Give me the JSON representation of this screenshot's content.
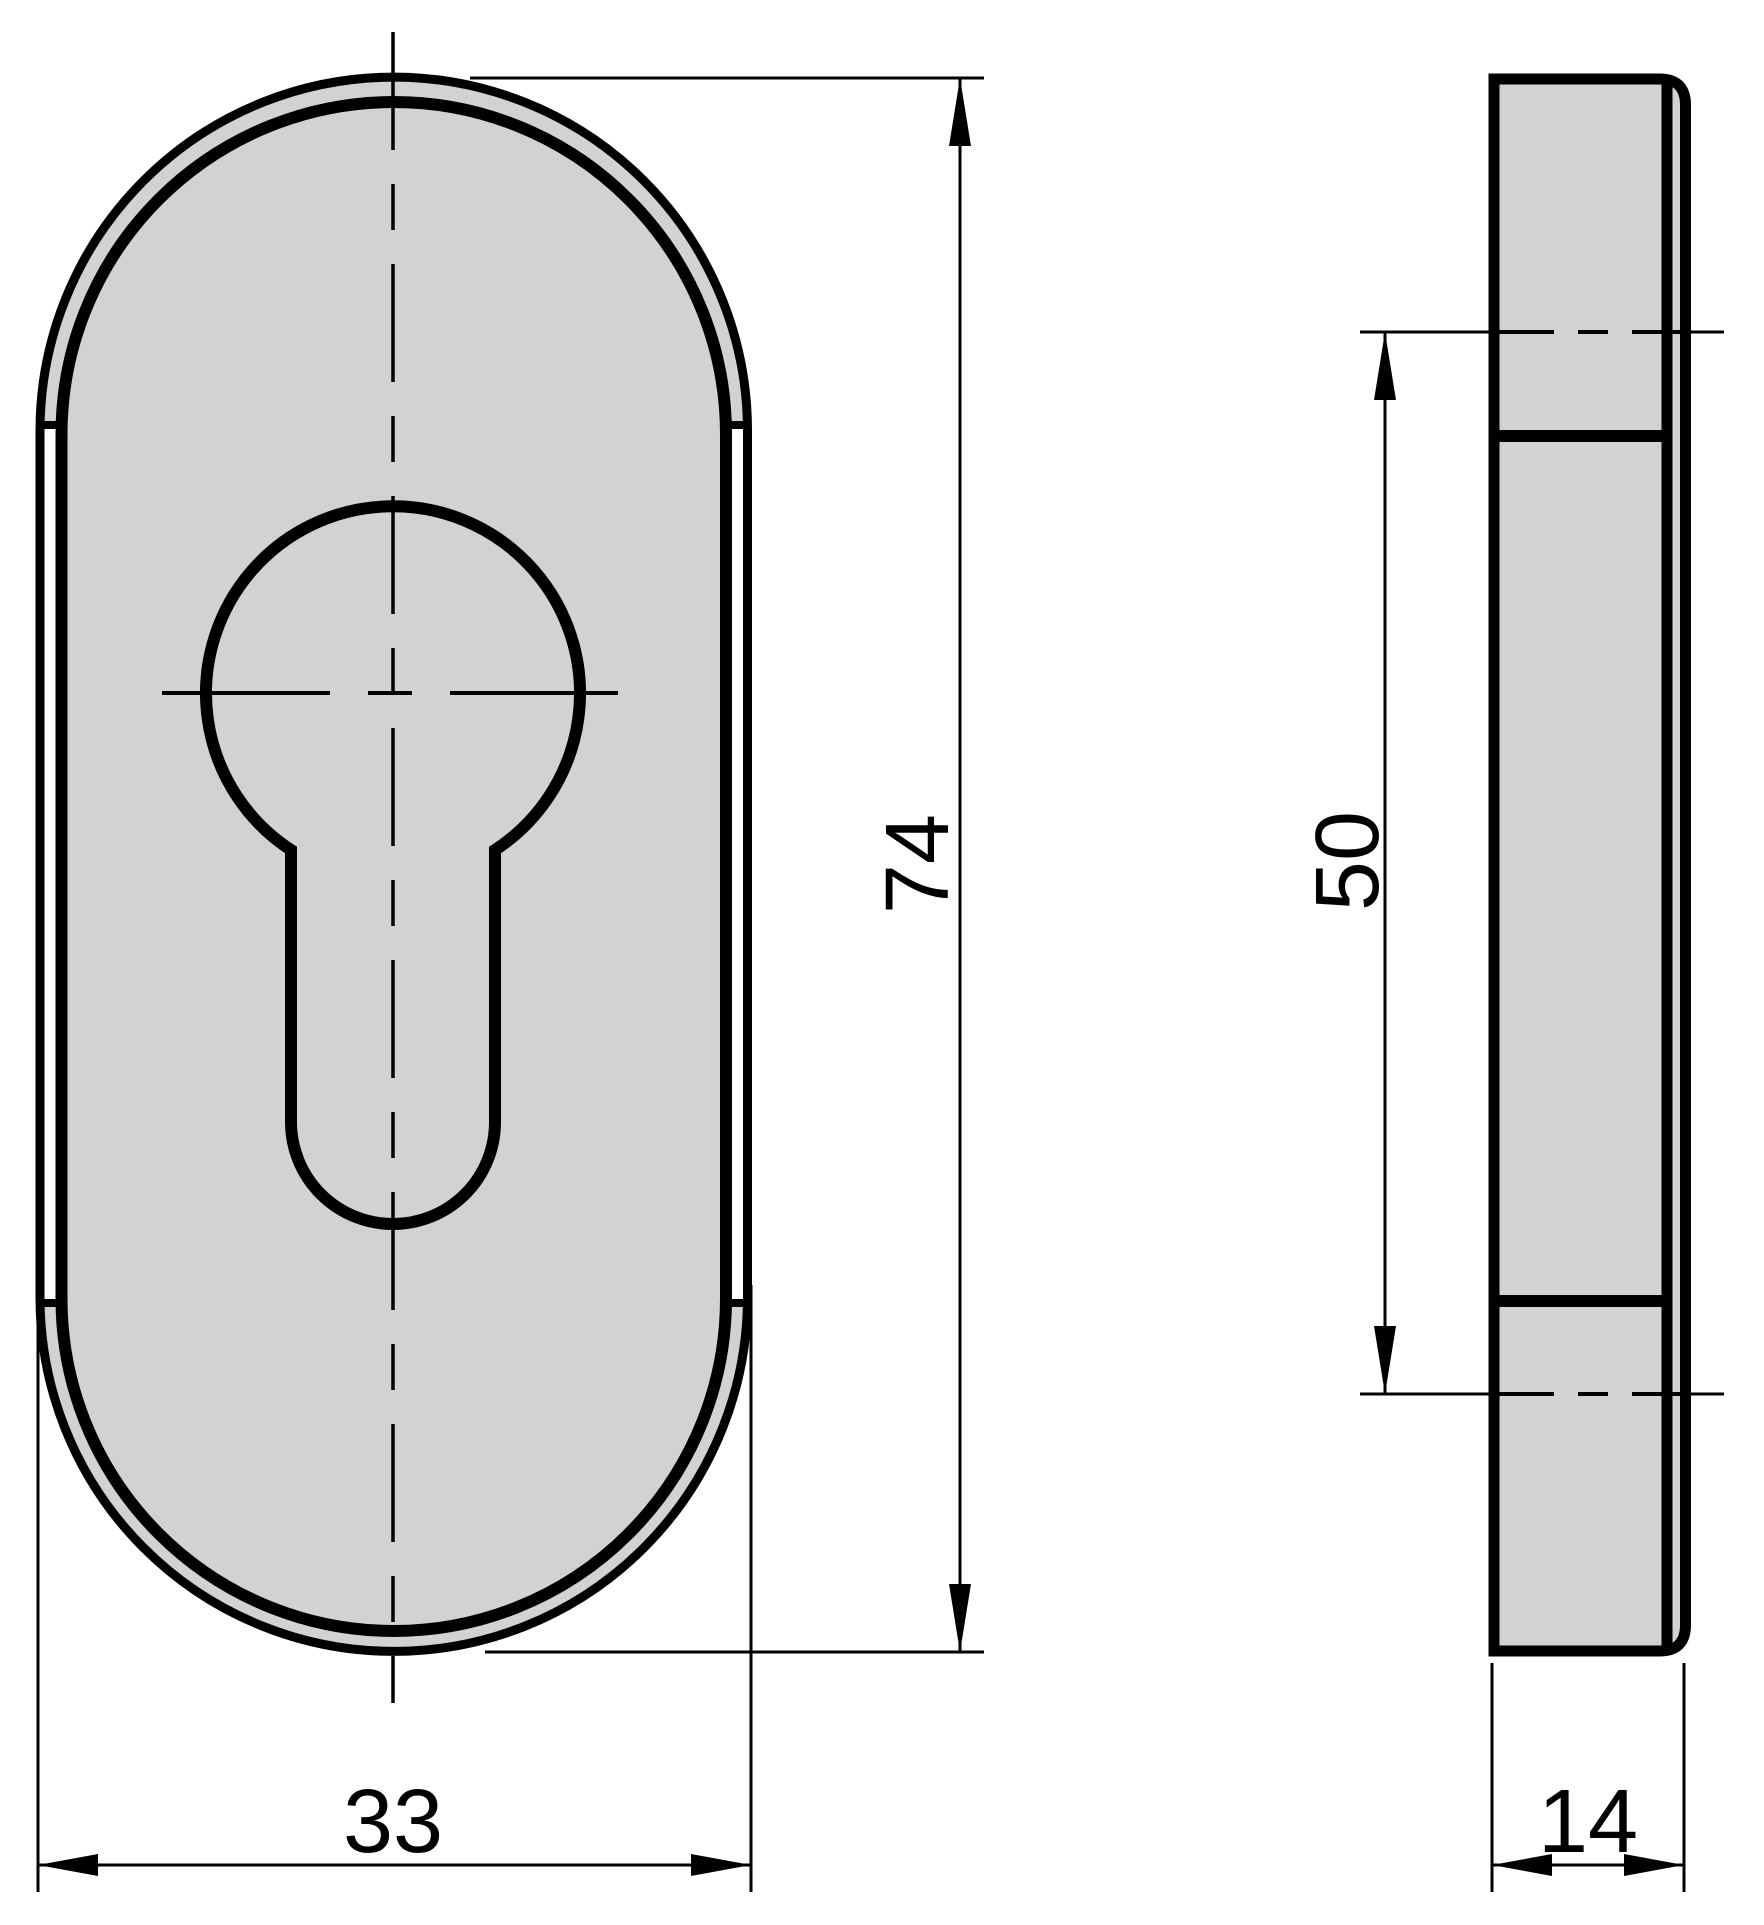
{
  "drawing": {
    "kind": "technical-drawing",
    "subject": "oval escutcheon plate with euro profile cylinder cutout, front and side views",
    "background": "#ffffff",
    "line_color": "#000000",
    "part_fill": "#d2d2d2",
    "hole_fill": "#ffffff",
    "dims": {
      "height": "74",
      "width": "33",
      "spacing": "50",
      "depth": "14"
    },
    "dimensions": [
      {
        "id": "height",
        "value": "74",
        "orientation": "vertical",
        "view": "front"
      },
      {
        "id": "width",
        "value": "33",
        "orientation": "horizontal",
        "view": "front"
      },
      {
        "id": "spacing",
        "value": "50",
        "orientation": "vertical",
        "view": "side"
      },
      {
        "id": "depth",
        "value": "14",
        "orientation": "horizontal",
        "view": "side"
      }
    ]
  }
}
